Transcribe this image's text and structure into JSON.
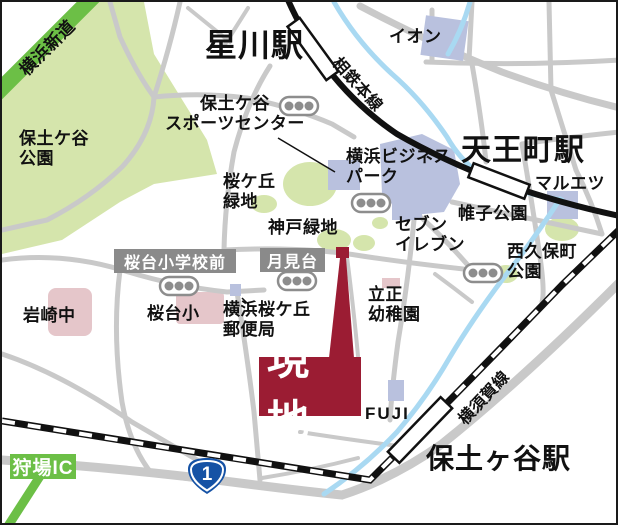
{
  "map": {
    "stations": {
      "hoshikawa": "星川駅",
      "tennocho": "天王町駅",
      "hodogaya": "保土ヶ谷駅"
    },
    "lines": {
      "sotetsu": "相鉄本線",
      "yokosuka": "横須賀線"
    },
    "roads": {
      "yokohama_shindo": "横浜新道",
      "kariba_ic": "狩場IC",
      "route1": "1"
    },
    "stops": {
      "sakuradai_shogakko_mae": "桜台小学校前",
      "tsukimidai": "月見台"
    },
    "places": {
      "hodogaya_park": "保土ケ谷\n公園",
      "sports_center": "保土ケ谷\nスポーツセンター",
      "aeon": "イオン",
      "yokohama_business_park": "横浜ビジネス\nパーク",
      "maruetsu": "マルエツ",
      "sakuragaoka_ryokuchi": "桜ケ丘\n緑地",
      "godo_ryokuchi": "神戸緑地",
      "seven_eleven": "セブン\nイレブン",
      "katabira_park": "帷子公園",
      "nishikubocho_park": "西久保町\n公園",
      "iwasaki_jhs": "岩崎中",
      "sakuradai_es": "桜台小",
      "post_office": "横浜桜ケ丘\n郵便局",
      "rissho_kindergarten": "立正\n幼稚園",
      "fuji": "FUJI"
    },
    "site": {
      "label": "現地"
    },
    "colors": {
      "site_maroon": "#9b1c33",
      "road_green": "#6cbf46",
      "park_green": "#d5e5ac",
      "building_blue": "#b9c1de",
      "school_pink": "#e5c6ca",
      "river_blue": "#a9d9f2",
      "road_gray": "#c9c9c9",
      "signal_gray": "#8d8d8d",
      "label_box_gray": "#8a8a8a",
      "route_shield_blue": "#1552a5",
      "rail_black": "#111111"
    }
  }
}
